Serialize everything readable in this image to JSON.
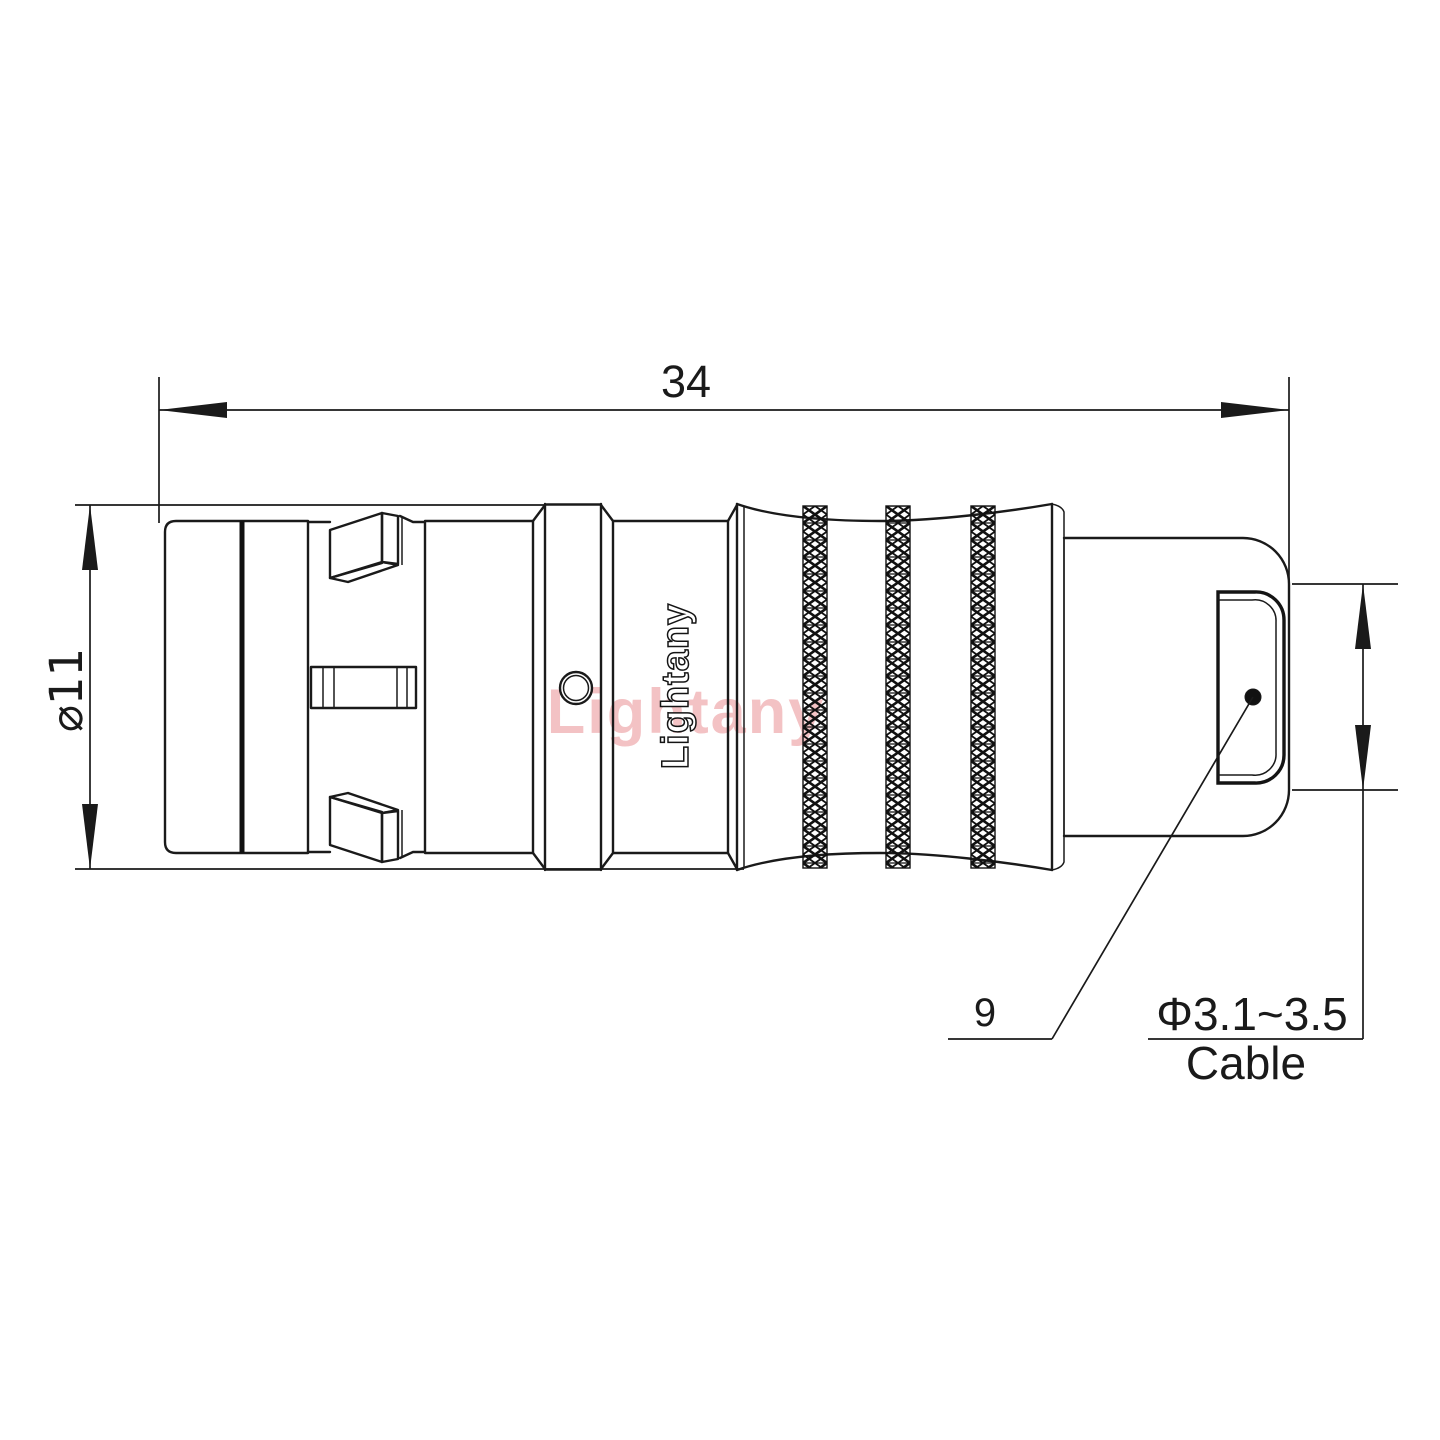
{
  "drawing": {
    "line_color": "#1a1a1a",
    "watermark_color": "#f3c2c4",
    "dimensions": {
      "overall_length": "34",
      "body_diameter": "⌀11",
      "boot_length": "9",
      "cable_range": "Φ3.1~3.5",
      "cable_label": "Cable"
    },
    "branding": {
      "logo": "Lightany",
      "watermark": "Lightany"
    }
  }
}
